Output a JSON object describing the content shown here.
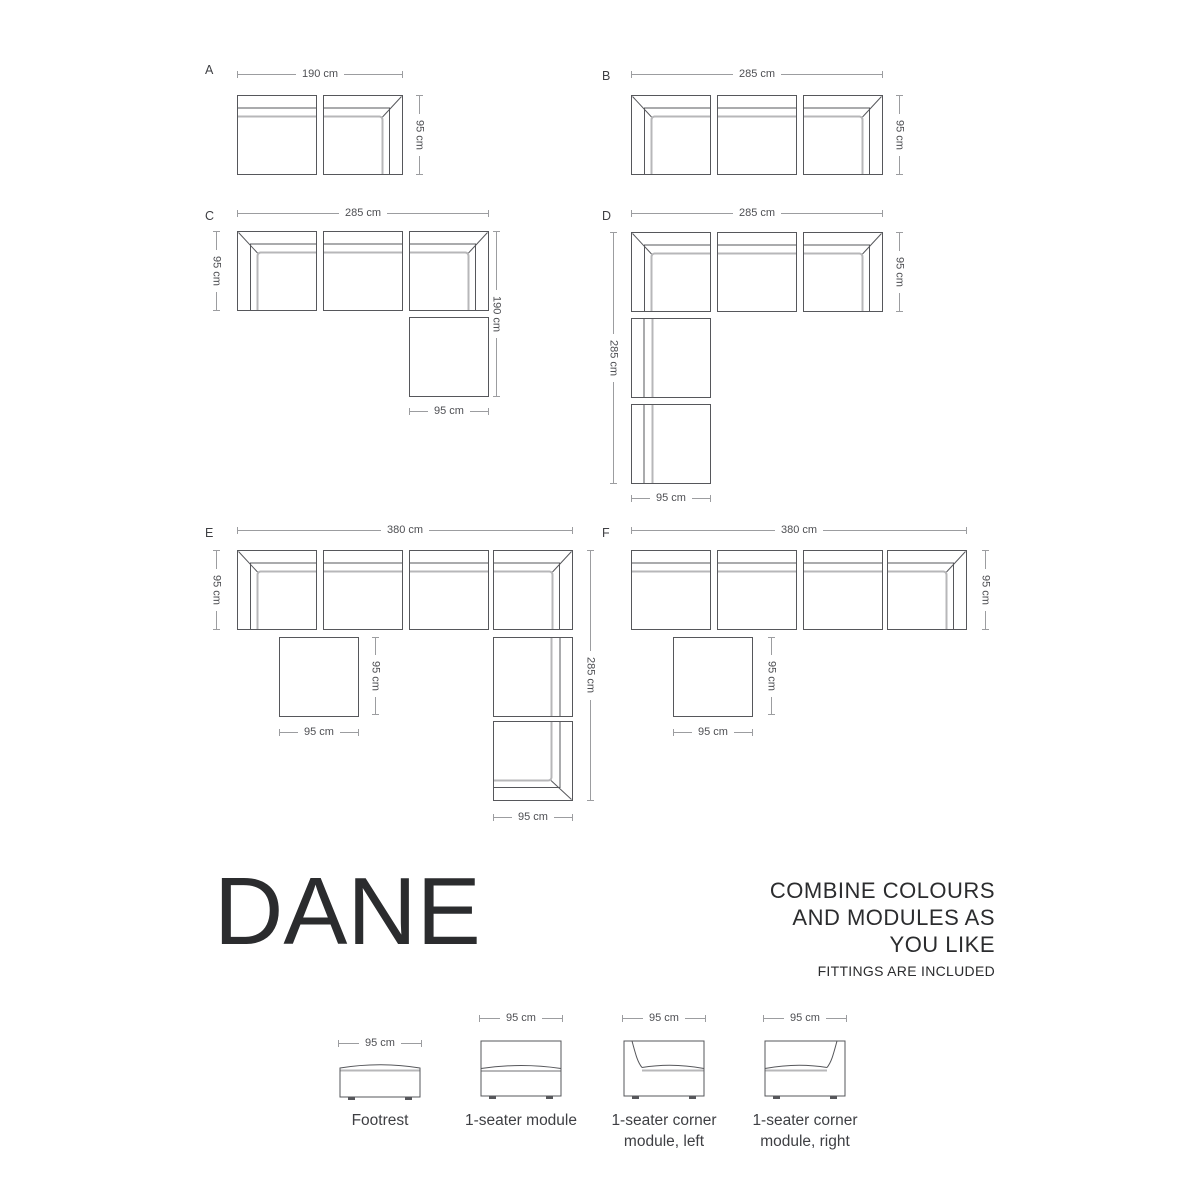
{
  "brand": {
    "title": "DANE"
  },
  "message": {
    "lines": [
      "COMBINE COLOURS",
      "AND MODULES AS",
      "YOU LIKE"
    ],
    "note": "FITTINGS ARE INCLUDED"
  },
  "colors": {
    "module_line": "#56575B",
    "cushion_line": "#B7B7B9",
    "dim_line": "#9C9DA0",
    "dim_text": "#4E4F53",
    "label_text": "#3E3F43",
    "title_text": "#2B2C2E"
  },
  "configs": [
    {
      "id": "A",
      "label": "A",
      "label_pos": [
        205,
        64
      ],
      "modules": [
        [
          "seat",
          237,
          95
        ],
        [
          "corner-right",
          323,
          95
        ]
      ],
      "dims": [
        [
          "h",
          "190 cm",
          237,
          74,
          166
        ],
        [
          "v",
          "95 cm",
          419,
          95,
          80
        ]
      ]
    },
    {
      "id": "B",
      "label": "B",
      "label_pos": [
        602,
        70
      ],
      "modules": [
        [
          "corner-left",
          631,
          95
        ],
        [
          "seat",
          717,
          95
        ],
        [
          "corner-right",
          803,
          95
        ]
      ],
      "dims": [
        [
          "h",
          "285 cm",
          631,
          74,
          252
        ],
        [
          "v",
          "95 cm",
          899,
          95,
          80
        ]
      ]
    },
    {
      "id": "C",
      "label": "C",
      "label_pos": [
        205,
        210
      ],
      "modules": [
        [
          "corner-left",
          237,
          231
        ],
        [
          "seat",
          323,
          231
        ],
        [
          "corner-right",
          409,
          231
        ],
        [
          "footrest",
          409,
          317
        ]
      ],
      "dims": [
        [
          "h",
          "285 cm",
          237,
          213,
          252
        ],
        [
          "v",
          "95 cm",
          216,
          231,
          80
        ],
        [
          "v",
          "190 cm",
          496,
          231,
          166
        ],
        [
          "h",
          "95 cm",
          409,
          411,
          80
        ]
      ]
    },
    {
      "id": "D",
      "label": "D",
      "label_pos": [
        602,
        210
      ],
      "modules": [
        [
          "corner-left",
          631,
          232
        ],
        [
          "seat",
          717,
          232
        ],
        [
          "corner-right",
          803,
          232
        ],
        [
          "seat-left",
          631,
          318
        ],
        [
          "seat-left",
          631,
          404
        ]
      ],
      "dims": [
        [
          "h",
          "285 cm",
          631,
          213,
          252
        ],
        [
          "v",
          "285 cm",
          613,
          232,
          252
        ],
        [
          "v",
          "95 cm",
          899,
          232,
          80
        ],
        [
          "h",
          "95 cm",
          631,
          498,
          80
        ]
      ]
    },
    {
      "id": "E",
      "label": "E",
      "label_pos": [
        205,
        527
      ],
      "modules": [
        [
          "corner-left",
          237,
          550
        ],
        [
          "seat",
          323,
          550
        ],
        [
          "seat",
          409,
          550
        ],
        [
          "corner-right",
          493,
          550
        ],
        [
          "footrest",
          279,
          637
        ],
        [
          "seat-right",
          493,
          637
        ],
        [
          "corner-right-bottom",
          493,
          721
        ]
      ],
      "dims": [
        [
          "h",
          "380 cm",
          237,
          530,
          336
        ],
        [
          "v",
          "95 cm",
          216,
          550,
          80
        ],
        [
          "v",
          "285 cm",
          590,
          550,
          251
        ],
        [
          "v",
          "95 cm",
          375,
          637,
          78
        ],
        [
          "h",
          "95 cm",
          279,
          732,
          80
        ],
        [
          "h",
          "95 cm",
          493,
          817,
          80
        ]
      ]
    },
    {
      "id": "F",
      "label": "F",
      "label_pos": [
        602,
        527
      ],
      "modules": [
        [
          "seat",
          631,
          550
        ],
        [
          "seat",
          717,
          550
        ],
        [
          "seat",
          803,
          550
        ],
        [
          "corner-right",
          887,
          550
        ],
        [
          "footrest",
          673,
          637
        ]
      ],
      "dims": [
        [
          "h",
          "380 cm",
          631,
          530,
          336
        ],
        [
          "v",
          "95 cm",
          985,
          550,
          80
        ],
        [
          "v",
          "95 cm",
          771,
          637,
          78
        ],
        [
          "h",
          "95 cm",
          673,
          732,
          80
        ]
      ]
    }
  ],
  "legend": [
    {
      "name": "footrest",
      "dim": "95 cm",
      "label_lines": [
        "Footrest"
      ],
      "x": 338,
      "dim_y": 1043,
      "box_y": 1059
    },
    {
      "name": "one-seater",
      "dim": "95 cm",
      "label_lines": [
        "1-seater module"
      ],
      "x": 479,
      "dim_y": 1018,
      "box_y": 1039
    },
    {
      "name": "corner-left",
      "dim": "95 cm",
      "label_lines": [
        "1-seater corner",
        "module, left"
      ],
      "x": 622,
      "dim_y": 1018,
      "box_y": 1039
    },
    {
      "name": "corner-right",
      "dim": "95 cm",
      "label_lines": [
        "1-seater corner",
        "module, right"
      ],
      "x": 763,
      "dim_y": 1018,
      "box_y": 1039
    }
  ]
}
